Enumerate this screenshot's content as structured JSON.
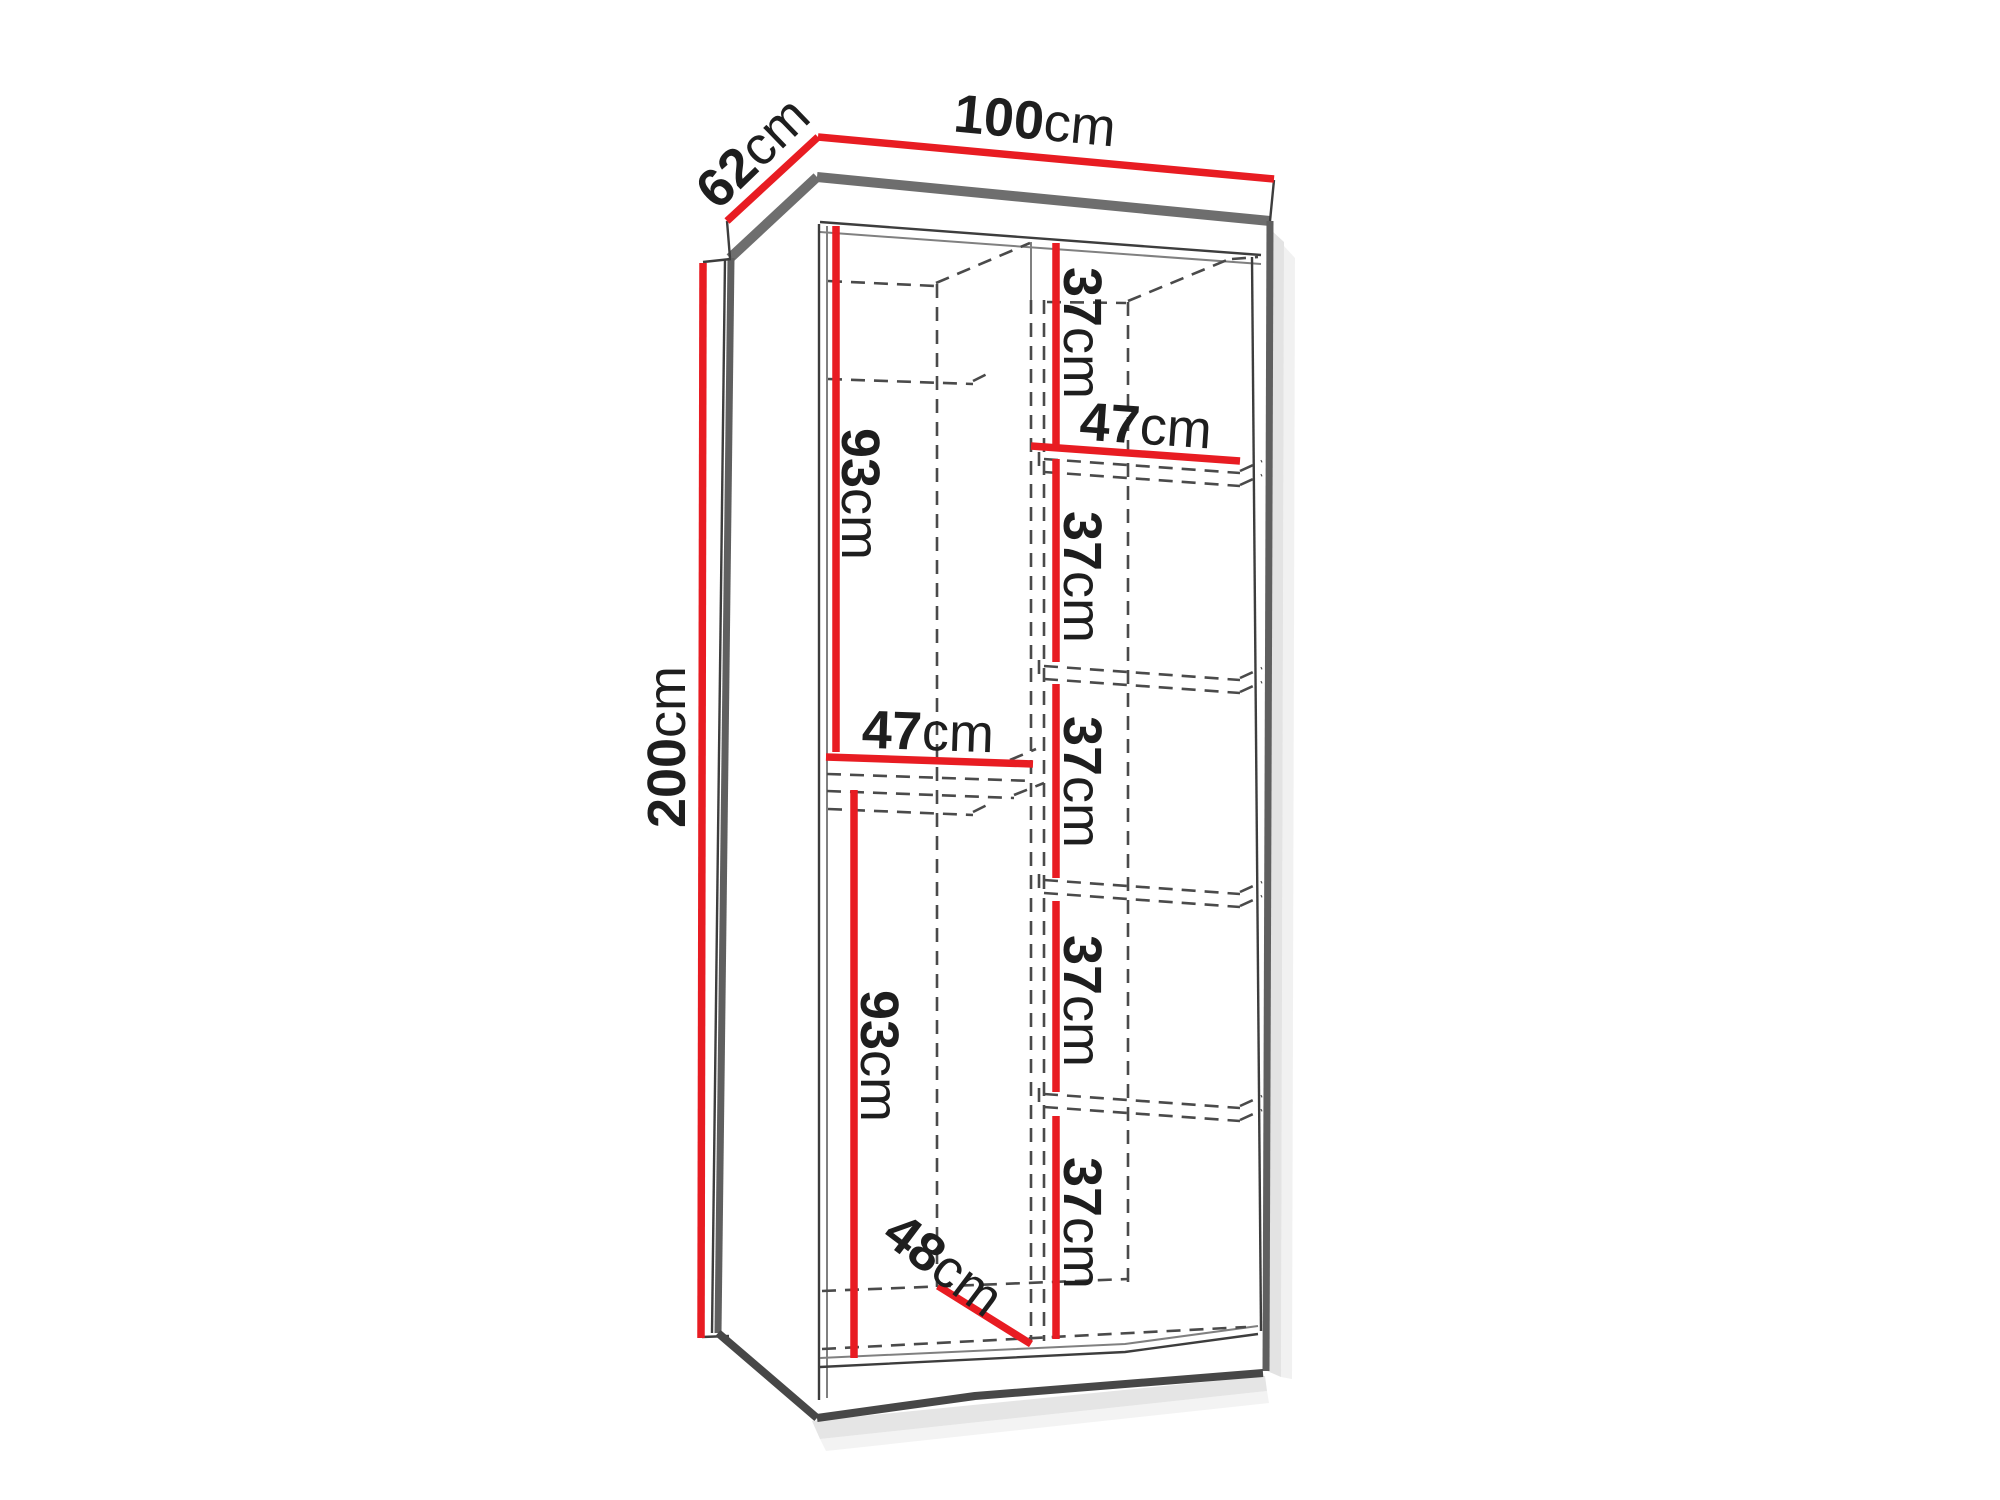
{
  "diagram": {
    "unit": "cm",
    "colors": {
      "dimension_line": "#e81c22",
      "outline": "#6e6e6e",
      "hidden_edge": "#4a4a4a",
      "text": "#1e1e1e",
      "background": "#ffffff"
    }
  },
  "labels": {
    "width": {
      "value": "100",
      "unit": "cm"
    },
    "depth": {
      "value": "62",
      "unit": "cm"
    },
    "height": {
      "value": "200",
      "unit": "cm"
    },
    "left_upper": {
      "value": "93",
      "unit": "cm"
    },
    "left_shelf": {
      "value": "47",
      "unit": "cm"
    },
    "left_lower": {
      "value": "93",
      "unit": "cm"
    },
    "floor_depth": {
      "value": "48",
      "unit": "cm"
    },
    "right_shelf": {
      "value": "47",
      "unit": "cm"
    },
    "right_sections": [
      {
        "value": "37",
        "unit": "cm"
      },
      {
        "value": "37",
        "unit": "cm"
      },
      {
        "value": "37",
        "unit": "cm"
      },
      {
        "value": "37",
        "unit": "cm"
      },
      {
        "value": "37",
        "unit": "cm"
      }
    ]
  }
}
